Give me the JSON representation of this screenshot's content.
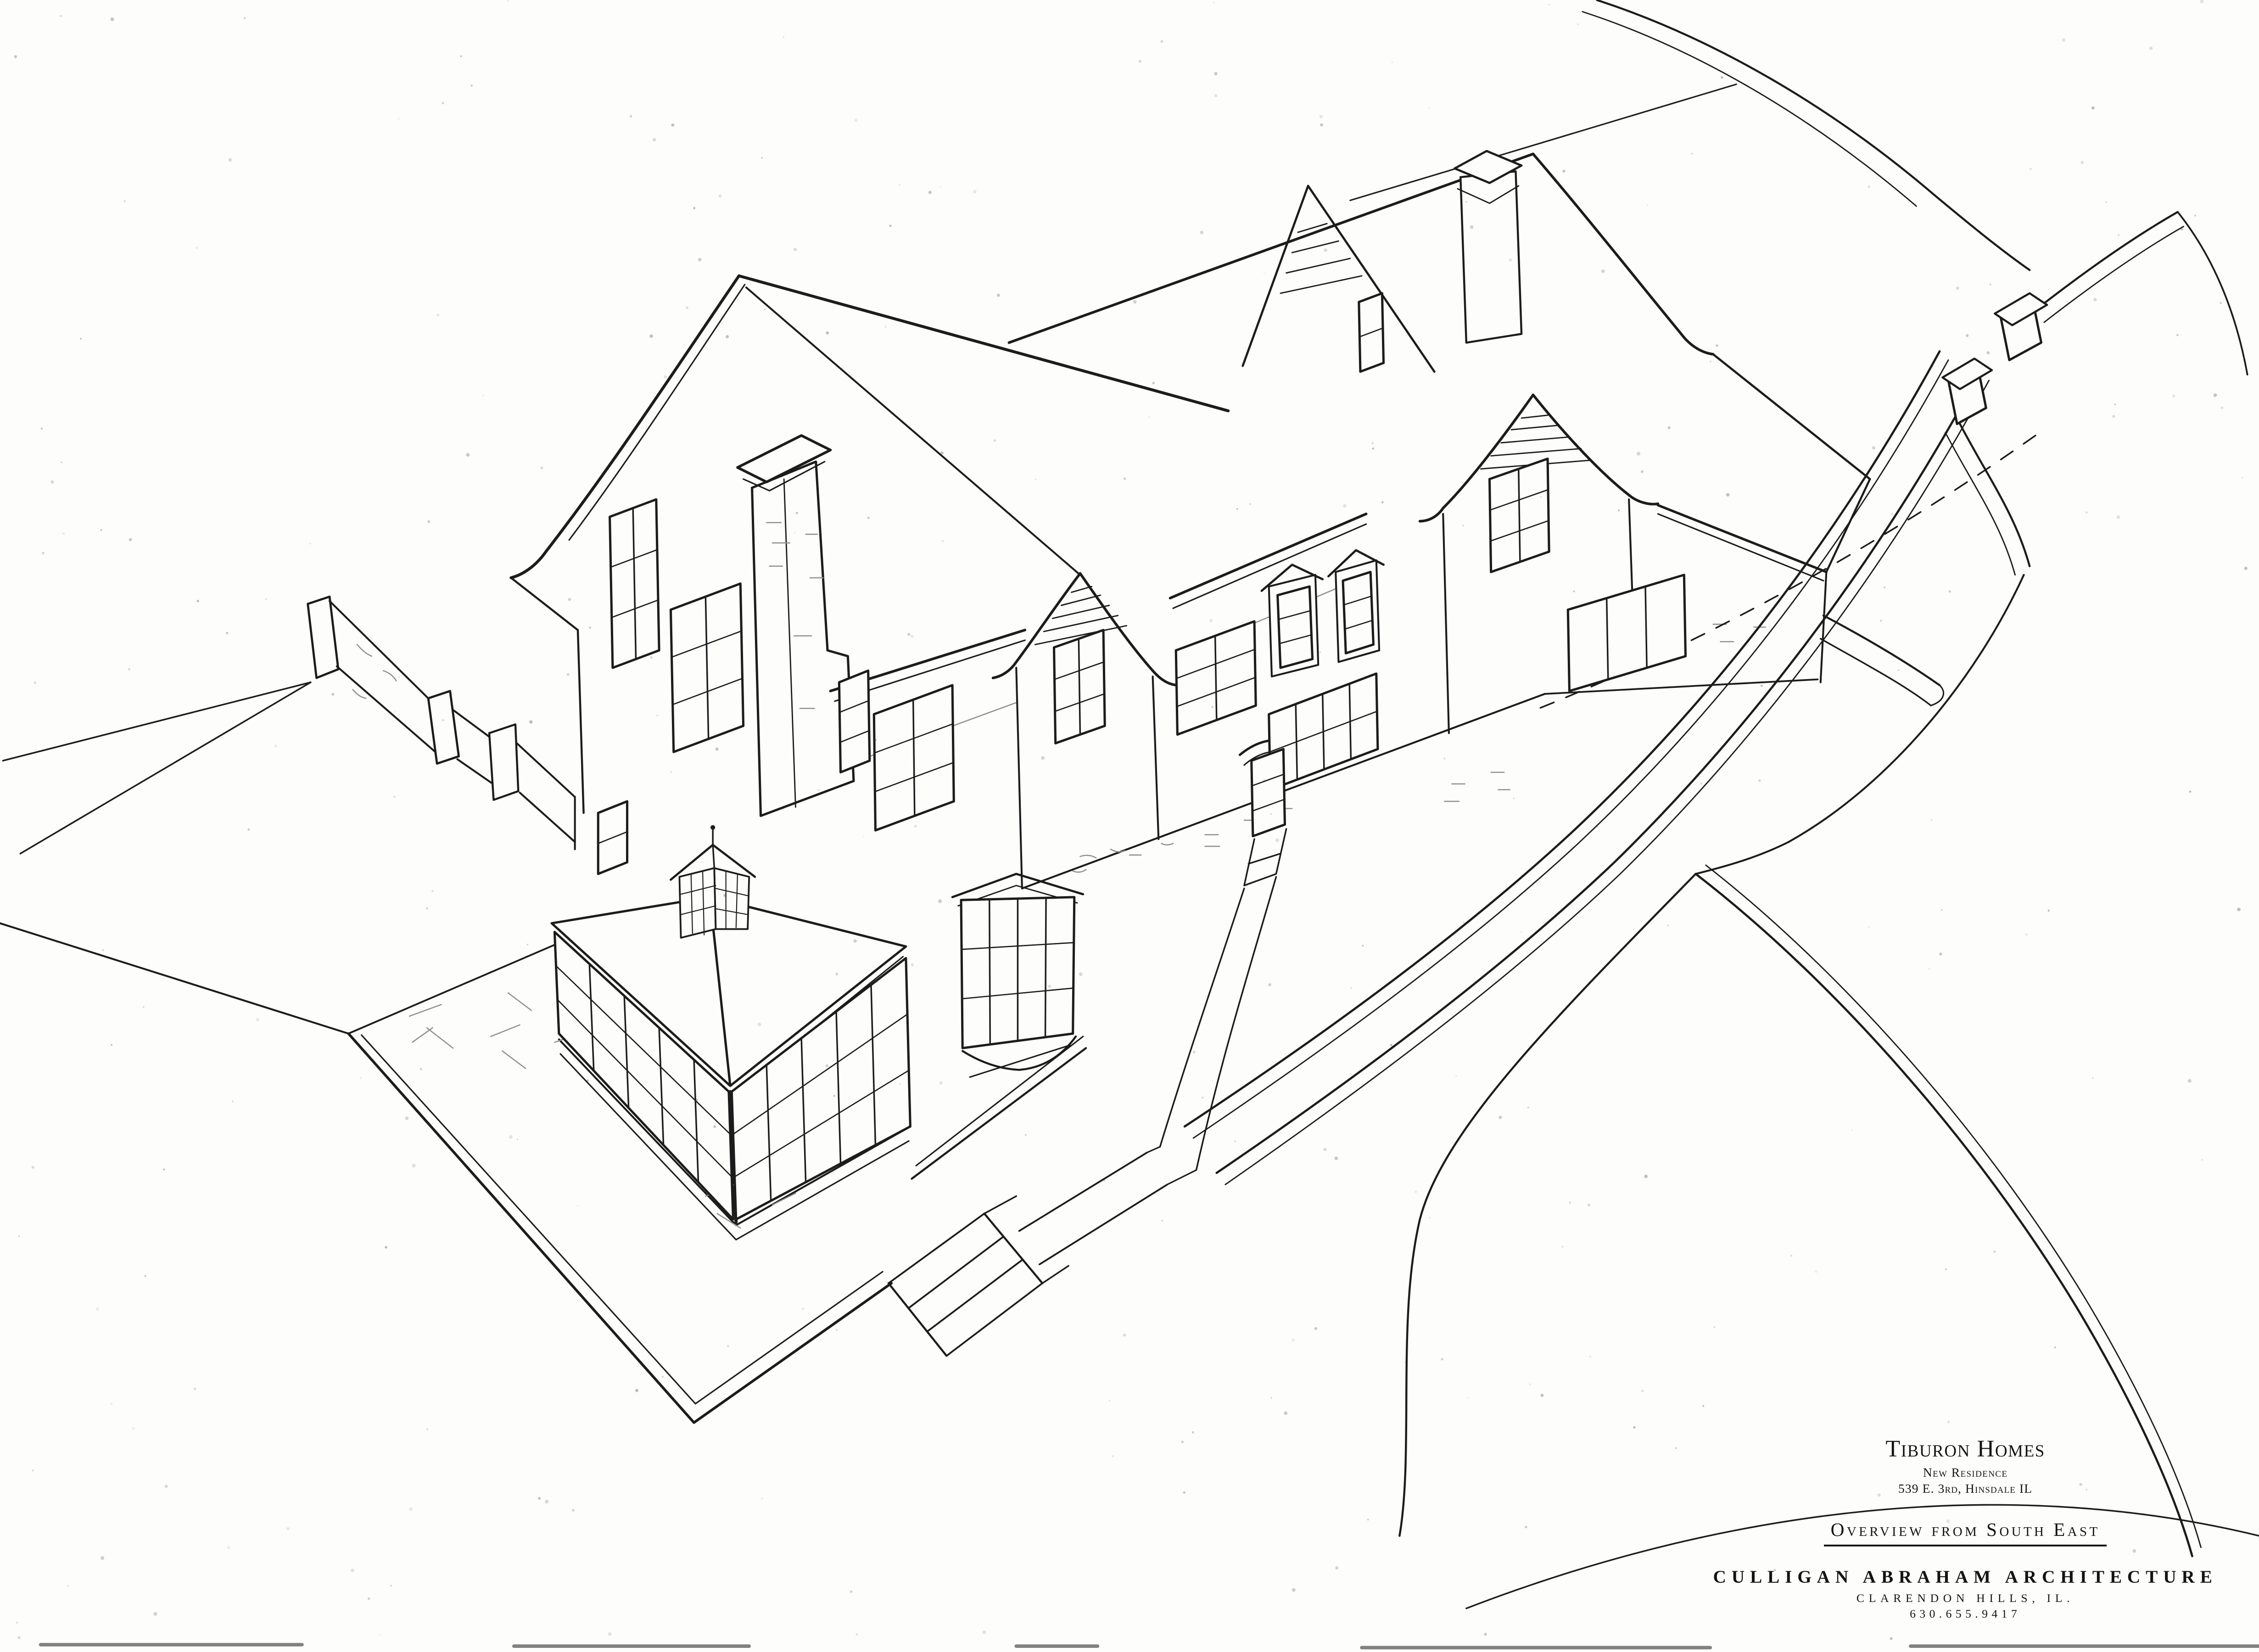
{
  "sheet": {
    "paper_color": "#fdfdfb",
    "ink_color": "#1c1c1c",
    "texture_ink_color": "#8f8f8f"
  },
  "title_block": {
    "builder": "Tiburon Homes",
    "project": "New Residence",
    "address": "539 E. 3rd, Hinsdale IL",
    "view_title": "Overview from South East",
    "firm": "CULLIGAN ABRAHAM ARCHITECTURE",
    "firm_city": "CLARENDON HILLS, IL.",
    "firm_phone": "630.655.9417"
  }
}
